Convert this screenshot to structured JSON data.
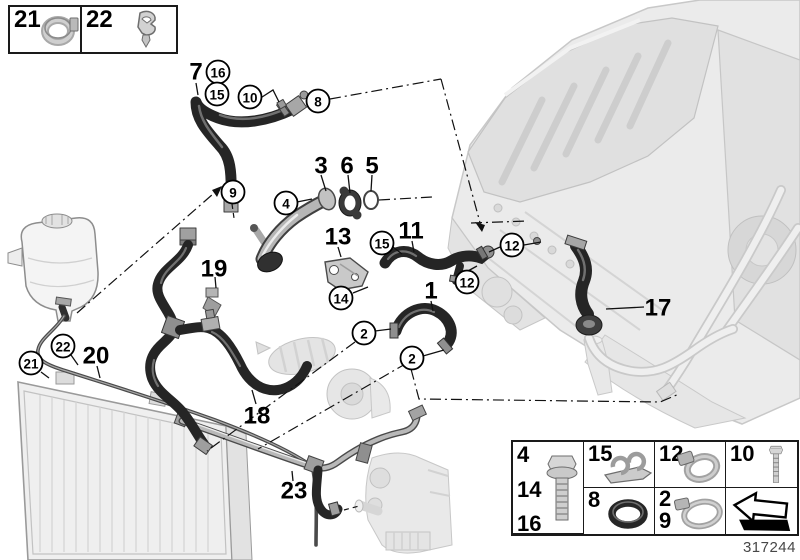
{
  "part_number": "317244",
  "legend_top": {
    "items": [
      {
        "label": "21",
        "icon": "hose-clamp-icon"
      },
      {
        "label": "22",
        "icon": "expansion-rivet-icon"
      }
    ]
  },
  "legend_table": {
    "cells": [
      {
        "labels": [
          "15"
        ],
        "icon": "line-clip-icon"
      },
      {
        "labels": [
          "8"
        ],
        "icon": "o-ring-icon"
      },
      {
        "labels": [
          "4",
          "14",
          "16"
        ],
        "icon": "flange-bolt-icon"
      },
      {
        "labels": [
          "12"
        ],
        "icon": "hose-clamp-small-icon"
      },
      {
        "labels": [
          "2",
          "9"
        ],
        "icon": "hose-clamp-large-icon"
      },
      {
        "labels": [
          "10"
        ],
        "icon": "hex-bolt-icon"
      },
      {
        "labels": [],
        "icon": "direction-arrow-icon"
      }
    ]
  },
  "callouts": {
    "circled": [
      {
        "label": "16",
        "x": 218,
        "y": 72
      },
      {
        "label": "15",
        "x": 217,
        "y": 94
      },
      {
        "label": "10",
        "x": 250,
        "y": 97
      },
      {
        "label": "8",
        "x": 318,
        "y": 101
      },
      {
        "label": "9",
        "x": 233,
        "y": 192
      },
      {
        "label": "4",
        "x": 286,
        "y": 203
      },
      {
        "label": "15",
        "x": 382,
        "y": 243
      },
      {
        "label": "12",
        "x": 512,
        "y": 245
      },
      {
        "label": "12",
        "x": 467,
        "y": 282
      },
      {
        "label": "14",
        "x": 341,
        "y": 298
      },
      {
        "label": "2",
        "x": 364,
        "y": 333
      },
      {
        "label": "2",
        "x": 412,
        "y": 358
      },
      {
        "label": "22",
        "x": 63,
        "y": 346
      },
      {
        "label": "21",
        "x": 31,
        "y": 363
      }
    ],
    "plain": [
      {
        "label": "7",
        "x": 196,
        "y": 71
      },
      {
        "label": "3",
        "x": 321,
        "y": 165
      },
      {
        "label": "6",
        "x": 347,
        "y": 165
      },
      {
        "label": "5",
        "x": 372,
        "y": 165
      },
      {
        "label": "13",
        "x": 338,
        "y": 236
      },
      {
        "label": "11",
        "x": 411,
        "y": 230
      },
      {
        "label": "19",
        "x": 214,
        "y": 268
      },
      {
        "label": "1",
        "x": 431,
        "y": 290
      },
      {
        "label": "20",
        "x": 96,
        "y": 355
      },
      {
        "label": "18",
        "x": 257,
        "y": 415
      },
      {
        "label": "17",
        "x": 658,
        "y": 307
      },
      {
        "label": "23",
        "x": 294,
        "y": 490
      }
    ]
  }
}
